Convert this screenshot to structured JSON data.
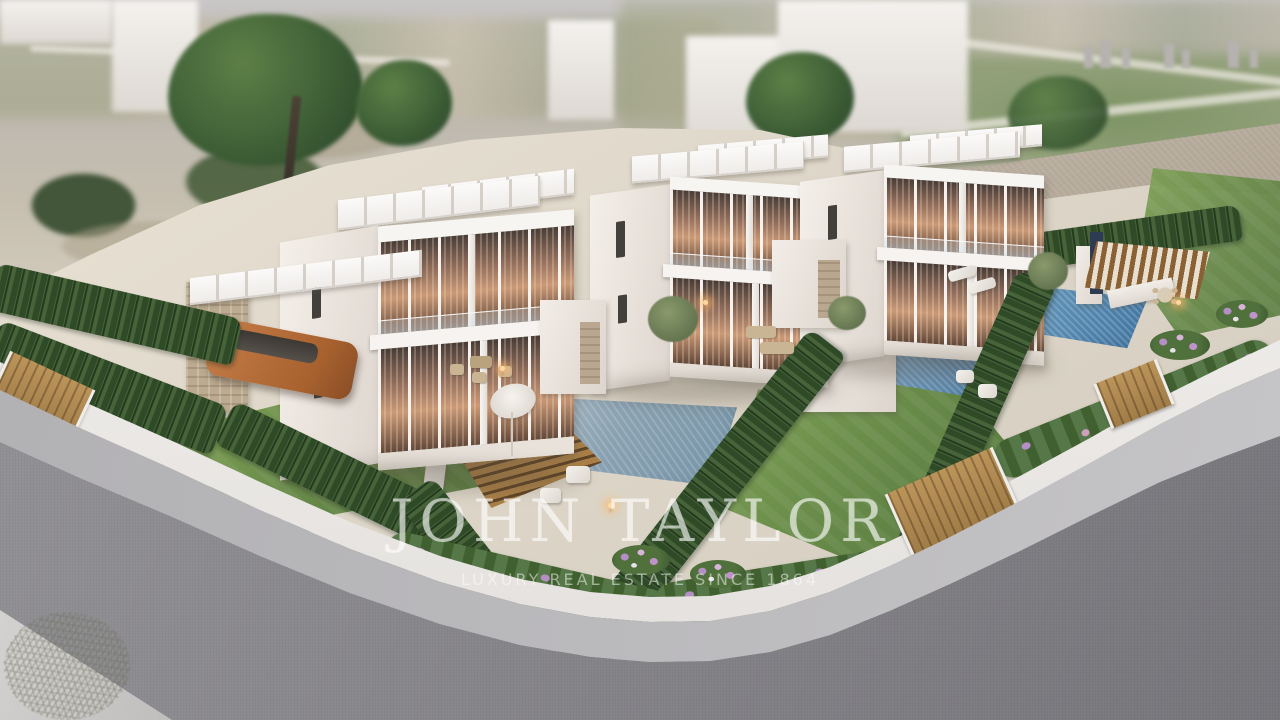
{
  "meta": {
    "type": "3d-architectural-render",
    "view": "aerial-drone-view",
    "subject": "Gated development of three modern two-storey white villas with private pools, gardens and a corner street"
  },
  "watermark": {
    "brand": "JOHN TAYLOR",
    "tagline": "LUXURY REAL ESTATE SINCE 1864"
  },
  "scene": {
    "villa_count": 3,
    "pool_count": 3,
    "features": [
      "flat-roof white villas with floor-to-ceiling glazing and warm interior light",
      "glass balustrade balconies",
      "private swimming pools",
      "timber pool decks and pergola cabana",
      "cypress hedges between plots",
      "white curved perimeter wall with timber gates",
      "carport with parked bronze car",
      "lawns and lilac flower beds",
      "grey asphalt corner road with light sidewalk",
      "blurred countryside and distant skyline background"
    ],
    "palette": {
      "sky": "#c7c4c5",
      "road": "#88878b",
      "sidewalk": "#b9b8bb",
      "wall_white": "#efedeb",
      "villa_white": "#f2ece6",
      "window_glow": "#c08a64",
      "lawn_green": "#6c9048",
      "cypress_green": "#3c5834",
      "pool_blue": "#4f86ad",
      "pool_grey_blue": "#8aa2b2",
      "deck_wood": "#a97f47",
      "gate_wood": "#b08a52",
      "stone": "#b5a58d",
      "car_bronze": "#b5703f",
      "flower_lilac": "#b48fc6"
    }
  }
}
